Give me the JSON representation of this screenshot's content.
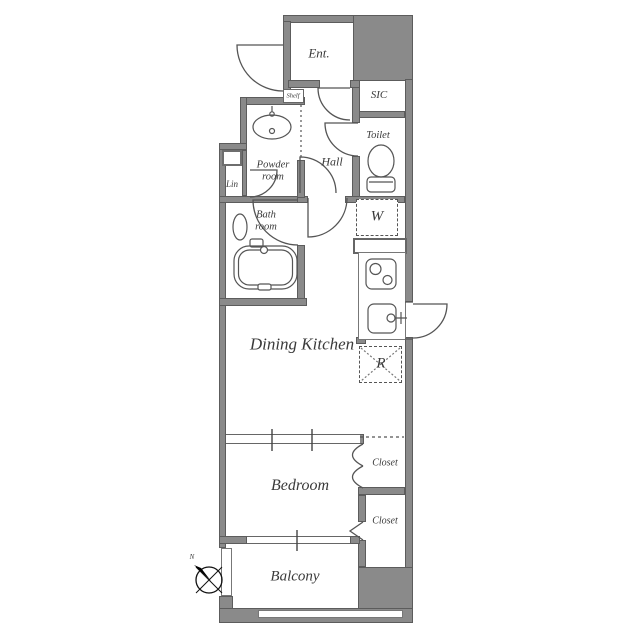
{
  "plan": {
    "labels": {
      "ent": "Ent.",
      "sic": "SIC",
      "toilet": "Toilet",
      "powder_room": "Powder\nroom",
      "hall": "Hall",
      "lin": "Lin",
      "bath_room": "Bath\nroom",
      "washer": "W",
      "dining_kitchen": "Dining Kitchen",
      "fridge": "R",
      "bedroom": "Bedroom",
      "closet_upper": "Closet",
      "closet_lower": "Closet",
      "balcony": "Balcony",
      "shelf": "Shelf",
      "compass_north": "N"
    },
    "colors": {
      "wall": "#8a8a8a",
      "wall_outline": "#5c5c5c",
      "line": "#555555",
      "text": "#3a3a3a",
      "background": "#ffffff"
    }
  }
}
